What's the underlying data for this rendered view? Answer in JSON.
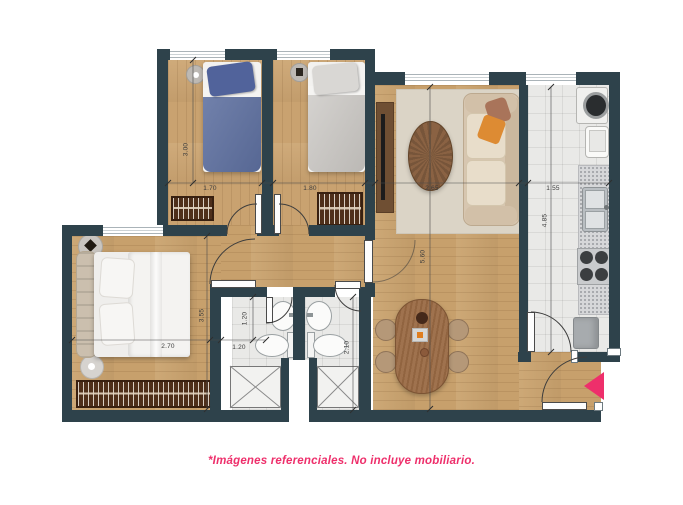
{
  "floorplan": {
    "caption": "*Imágenes referenciales. No incluye mobiliario.",
    "colors": {
      "accent_pink": "#ee2f6b",
      "wall": "#2e424b",
      "wood_floor": "#c7a06c",
      "tile_floor": "#e9e9e7"
    },
    "icons": {
      "entrance": "entrance-arrow"
    },
    "dimensions": {
      "bedroom1_depth": "3.00",
      "bedroom1_width": "1.70",
      "bedroom2_width": "1.80",
      "living_width": "2.65",
      "kitchen_width": "1.55",
      "living_depth": "5.60",
      "kitchen_depth": "4.85",
      "master_depth": "3.55",
      "master_width": "2.70",
      "bath1_depth": "1.20",
      "bath1_width": "1.20",
      "bath2_depth": "2.10"
    }
  }
}
